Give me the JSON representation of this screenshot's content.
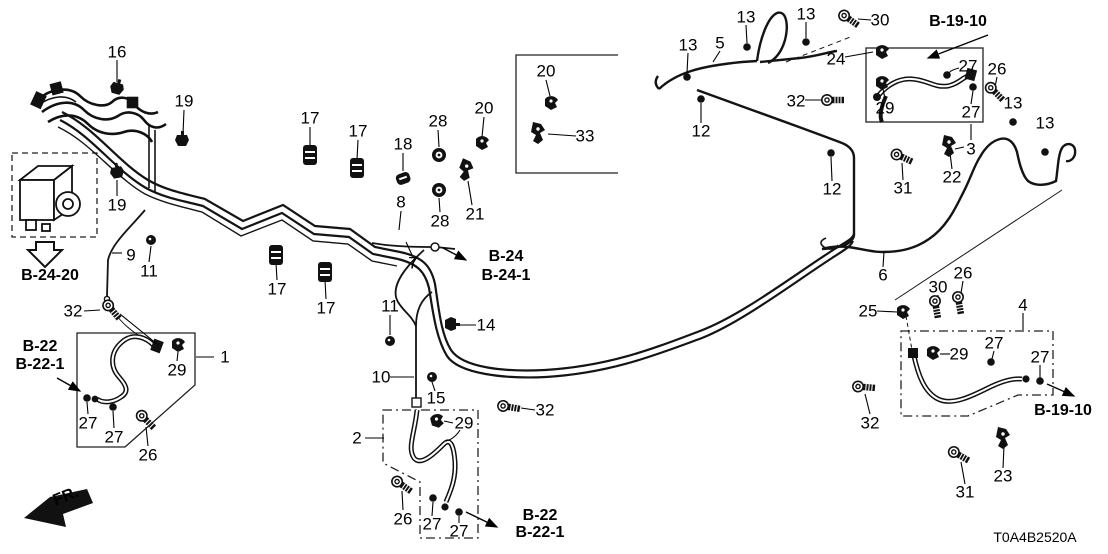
{
  "diagram": {
    "title": "brake-lines-parts-diagram",
    "code": "T0A4B2520A",
    "fr_label": "FR.",
    "line_color": "#141414",
    "part_labels": [
      {
        "text": "16",
        "x": 117,
        "y": 52
      },
      {
        "text": "19",
        "x": 184,
        "y": 101
      },
      {
        "text": "19",
        "x": 117,
        "y": 205
      },
      {
        "text": "17",
        "x": 310,
        "y": 118
      },
      {
        "text": "17",
        "x": 358,
        "y": 131
      },
      {
        "text": "18",
        "x": 403,
        "y": 144
      },
      {
        "text": "28",
        "x": 438,
        "y": 121
      },
      {
        "text": "20",
        "x": 484,
        "y": 108
      },
      {
        "text": "20",
        "x": 546,
        "y": 71
      },
      {
        "text": "33",
        "x": 585,
        "y": 136
      },
      {
        "text": "28",
        "x": 440,
        "y": 221
      },
      {
        "text": "21",
        "x": 475,
        "y": 214
      },
      {
        "text": "8",
        "x": 401,
        "y": 202
      },
      {
        "text": "7",
        "x": 413,
        "y": 263
      },
      {
        "text": "17",
        "x": 277,
        "y": 289
      },
      {
        "text": "17",
        "x": 326,
        "y": 308
      },
      {
        "text": "9",
        "x": 131,
        "y": 255
      },
      {
        "text": "11",
        "x": 149,
        "y": 271
      },
      {
        "text": "32",
        "x": 73,
        "y": 311
      },
      {
        "text": "1",
        "x": 225,
        "y": 357
      },
      {
        "text": "29",
        "x": 177,
        "y": 370
      },
      {
        "text": "27",
        "x": 88,
        "y": 423
      },
      {
        "text": "27",
        "x": 114,
        "y": 437
      },
      {
        "text": "26",
        "x": 148,
        "y": 455
      },
      {
        "text": "11",
        "x": 390,
        "y": 306
      },
      {
        "text": "14",
        "x": 486,
        "y": 325
      },
      {
        "text": "10",
        "x": 381,
        "y": 377
      },
      {
        "text": "15",
        "x": 436,
        "y": 398
      },
      {
        "text": "2",
        "x": 357,
        "y": 438
      },
      {
        "text": "29",
        "x": 464,
        "y": 423
      },
      {
        "text": "32",
        "x": 545,
        "y": 410
      },
      {
        "text": "26",
        "x": 403,
        "y": 519
      },
      {
        "text": "27",
        "x": 432,
        "y": 524
      },
      {
        "text": "27",
        "x": 459,
        "y": 531
      },
      {
        "text": "13",
        "x": 688,
        "y": 45
      },
      {
        "text": "5",
        "x": 720,
        "y": 43
      },
      {
        "text": "13",
        "x": 746,
        "y": 17
      },
      {
        "text": "13",
        "x": 806,
        "y": 14
      },
      {
        "text": "30",
        "x": 880,
        "y": 20
      },
      {
        "text": "24",
        "x": 836,
        "y": 59
      },
      {
        "text": "32",
        "x": 796,
        "y": 101
      },
      {
        "text": "12",
        "x": 701,
        "y": 131
      },
      {
        "text": "29",
        "x": 885,
        "y": 108
      },
      {
        "text": "27",
        "x": 968,
        "y": 66
      },
      {
        "text": "26",
        "x": 997,
        "y": 69
      },
      {
        "text": "27",
        "x": 971,
        "y": 112
      },
      {
        "text": "13",
        "x": 1013,
        "y": 103
      },
      {
        "text": "13",
        "x": 1045,
        "y": 123
      },
      {
        "text": "3",
        "x": 971,
        "y": 149
      },
      {
        "text": "22",
        "x": 952,
        "y": 177
      },
      {
        "text": "31",
        "x": 903,
        "y": 188
      },
      {
        "text": "12",
        "x": 832,
        "y": 189
      },
      {
        "text": "6",
        "x": 883,
        "y": 275
      },
      {
        "text": "25",
        "x": 868,
        "y": 311
      },
      {
        "text": "30",
        "x": 938,
        "y": 287
      },
      {
        "text": "26",
        "x": 963,
        "y": 273
      },
      {
        "text": "4",
        "x": 1023,
        "y": 305
      },
      {
        "text": "29",
        "x": 959,
        "y": 354
      },
      {
        "text": "27",
        "x": 994,
        "y": 343
      },
      {
        "text": "27",
        "x": 1040,
        "y": 357
      },
      {
        "text": "32",
        "x": 870,
        "y": 423
      },
      {
        "text": "23",
        "x": 1003,
        "y": 476
      },
      {
        "text": "31",
        "x": 965,
        "y": 492
      }
    ],
    "ref_labels": [
      {
        "text": "B-24-20",
        "x": 50,
        "y": 276
      },
      {
        "text": "B-22",
        "x": 40,
        "y": 347
      },
      {
        "text": "B-22-1",
        "x": 40,
        "y": 365
      },
      {
        "text": "B-24",
        "x": 506,
        "y": 257
      },
      {
        "text": "B-24-1",
        "x": 506,
        "y": 276
      },
      {
        "text": "B-22",
        "x": 540,
        "y": 516
      },
      {
        "text": "B-22-1",
        "x": 540,
        "y": 533
      },
      {
        "text": "B-19-10",
        "x": 958,
        "y": 22
      },
      {
        "text": "B-19-10",
        "x": 1063,
        "y": 411
      }
    ],
    "icons": [
      {
        "type": "clip",
        "name": "clip-16-icon",
        "x": 117,
        "y": 88,
        "r": 15
      },
      {
        "type": "clip",
        "name": "clip-19-icon",
        "x": 182,
        "y": 140,
        "r": 0
      },
      {
        "type": "clip",
        "name": "clip-19b-icon",
        "x": 117,
        "y": 172,
        "r": -10
      },
      {
        "type": "mount",
        "name": "rubber-mount-17-icon",
        "x": 310,
        "y": 155,
        "r": 0
      },
      {
        "type": "mount",
        "name": "rubber-mount-17-icon",
        "x": 357,
        "y": 168,
        "r": 0
      },
      {
        "type": "mountsm",
        "name": "rubber-mount-18-icon",
        "x": 403,
        "y": 178,
        "r": -20
      },
      {
        "type": "grommet",
        "name": "grommet-28-icon",
        "x": 439,
        "y": 155,
        "r": 0
      },
      {
        "type": "clamp",
        "name": "clamp-20-icon",
        "x": 482,
        "y": 143,
        "r": 0
      },
      {
        "type": "clamp",
        "name": "clamp-20b-icon",
        "x": 551,
        "y": 103,
        "r": 0
      },
      {
        "type": "bracket",
        "name": "bracket-33-icon",
        "x": 538,
        "y": 133,
        "r": 0
      },
      {
        "type": "grommet",
        "name": "grommet-28b-icon",
        "x": 439,
        "y": 190,
        "r": 0
      },
      {
        "type": "bracket",
        "name": "bracket-21-icon",
        "x": 466,
        "y": 170,
        "r": 10
      },
      {
        "type": "mount",
        "name": "rubber-mount-17c-icon",
        "x": 276,
        "y": 255,
        "r": 0
      },
      {
        "type": "mount",
        "name": "rubber-mount-17d-icon",
        "x": 325,
        "y": 272,
        "r": 0
      },
      {
        "type": "nut",
        "name": "nut-11-icon",
        "x": 151,
        "y": 240,
        "r": 0
      },
      {
        "type": "bolt",
        "name": "bolt-32a-icon",
        "x": 112,
        "y": 310,
        "r": 50
      },
      {
        "type": "clamp",
        "name": "clamp-29a-icon",
        "x": 178,
        "y": 345,
        "r": 0
      },
      {
        "type": "dot",
        "name": "washer-27-icon",
        "x": 87,
        "y": 398,
        "r": 0
      },
      {
        "type": "dot",
        "name": "washer-27b-icon",
        "x": 113,
        "y": 407,
        "r": 0
      },
      {
        "type": "bolt",
        "name": "bolt-26a-icon",
        "x": 146,
        "y": 420,
        "r": 45
      },
      {
        "type": "nut",
        "name": "nut-11b-icon",
        "x": 390,
        "y": 341,
        "r": 0
      },
      {
        "type": "clip",
        "name": "clip-14-icon",
        "x": 451,
        "y": 324,
        "r": 90
      },
      {
        "type": "nut",
        "name": "nut-15-icon",
        "x": 432,
        "y": 377,
        "r": 0
      },
      {
        "type": "clamp",
        "name": "clamp-29b-icon",
        "x": 437,
        "y": 421,
        "r": -15
      },
      {
        "type": "bolt",
        "name": "bolt-32b-icon",
        "x": 509,
        "y": 407,
        "r": 10
      },
      {
        "type": "bolt",
        "name": "bolt-26b-icon",
        "x": 402,
        "y": 485,
        "r": 35
      },
      {
        "type": "dot",
        "name": "washer-27c-icon",
        "x": 433,
        "y": 498,
        "r": 0
      },
      {
        "type": "dot",
        "name": "washer-27d-icon",
        "x": 459,
        "y": 512,
        "r": 0
      },
      {
        "type": "dot",
        "name": "clip-13a-icon",
        "x": 687,
        "y": 77,
        "r": 0
      },
      {
        "type": "dot",
        "name": "clip-13b-icon",
        "x": 747,
        "y": 47,
        "r": 0
      },
      {
        "type": "dot",
        "name": "clip-13c-icon",
        "x": 806,
        "y": 42,
        "r": 0
      },
      {
        "type": "bolt",
        "name": "bolt-30a-icon",
        "x": 849,
        "y": 19,
        "r": 35
      },
      {
        "type": "clamp",
        "name": "clamp-24-icon",
        "x": 882,
        "y": 52,
        "r": 0
      },
      {
        "type": "bolt",
        "name": "bolt-32c-icon",
        "x": 833,
        "y": 100,
        "r": 0
      },
      {
        "type": "dot",
        "name": "clip-12a-icon",
        "x": 701,
        "y": 99,
        "r": 0
      },
      {
        "type": "clamp",
        "name": "clamp-29c-icon",
        "x": 882,
        "y": 83,
        "r": 0
      },
      {
        "type": "dot",
        "name": "stud-27e-icon",
        "x": 947,
        "y": 75,
        "r": 0
      },
      {
        "type": "dot",
        "name": "stud-27f-icon",
        "x": 973,
        "y": 87,
        "r": 0
      },
      {
        "type": "bolt",
        "name": "bolt-26c-icon",
        "x": 995,
        "y": 92,
        "r": 45
      },
      {
        "type": "bracket",
        "name": "bracket-22-icon",
        "x": 949,
        "y": 146,
        "r": 0
      },
      {
        "type": "bolt",
        "name": "bolt-31a-icon",
        "x": 902,
        "y": 157,
        "r": 25
      },
      {
        "type": "dot",
        "name": "clip-13d-icon",
        "x": 1013,
        "y": 122,
        "r": 0
      },
      {
        "type": "dot",
        "name": "clip-13e-icon",
        "x": 1045,
        "y": 152,
        "r": 0
      },
      {
        "type": "dot",
        "name": "clip-12b-icon",
        "x": 831,
        "y": 153,
        "r": 0
      },
      {
        "type": "clamp",
        "name": "connector-25-icon",
        "x": 903,
        "y": 312,
        "r": 0
      },
      {
        "type": "bolt",
        "name": "bolt-30b-icon",
        "x": 936,
        "y": 307,
        "r": 80
      },
      {
        "type": "bolt",
        "name": "bolt-26d-icon",
        "x": 959,
        "y": 303,
        "r": 80
      },
      {
        "type": "clamp",
        "name": "clamp-29d-icon",
        "x": 933,
        "y": 353,
        "r": 0
      },
      {
        "type": "dot",
        "name": "washer-27g-icon",
        "x": 991,
        "y": 362,
        "r": 0
      },
      {
        "type": "dot",
        "name": "washer-27h-icon",
        "x": 1040,
        "y": 381,
        "r": 0
      },
      {
        "type": "bolt",
        "name": "bolt-32d-icon",
        "x": 864,
        "y": 387,
        "r": 5
      },
      {
        "type": "bracket",
        "name": "bracket-23-icon",
        "x": 1003,
        "y": 438,
        "r": 0
      },
      {
        "type": "bolt",
        "name": "bolt-31b-icon",
        "x": 959,
        "y": 455,
        "r": 30
      }
    ]
  }
}
